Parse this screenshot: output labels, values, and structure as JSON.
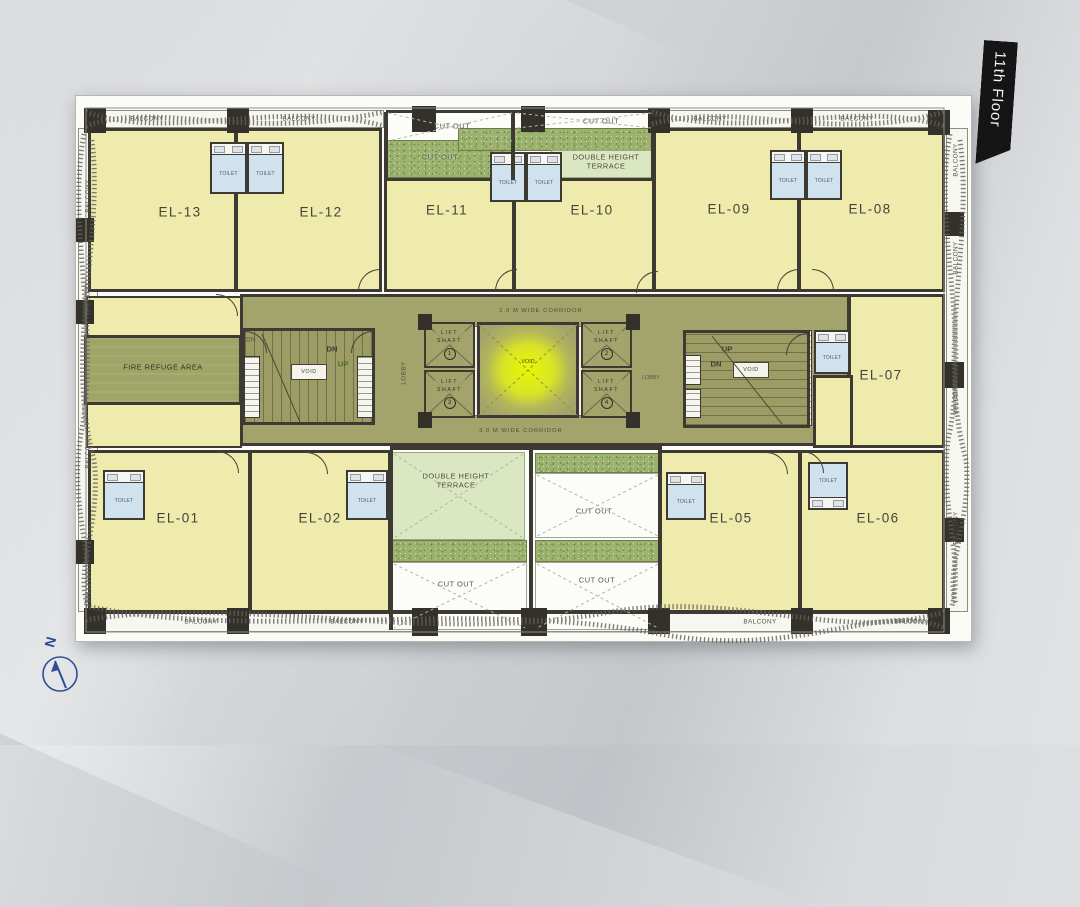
{
  "banner": {
    "text": "11th Floor"
  },
  "compass": {
    "north": "N"
  },
  "corridors": {
    "top": "2.0 M WIDE CORRIDOR",
    "bottom": "3.0 M WIDE CORRIDOR"
  },
  "areas": {
    "fire_refuge": "FIRE REFUGE AREA",
    "double_height_terrace": "DOUBLE HEIGHT TERRACE",
    "cut_out": "CUT OUT",
    "void": "VOID",
    "lobby": "LOBBY",
    "balcony": "BALCONY",
    "toilet": "TOILET",
    "up": "UP",
    "dn": "DN"
  },
  "lift_shafts": [
    {
      "label": "LIFT SHAFT",
      "number": "1"
    },
    {
      "label": "LIFT SHAFT",
      "number": "2"
    },
    {
      "label": "LIFT SHAFT",
      "number": "3"
    },
    {
      "label": "LIFT SHAFT",
      "number": "4"
    }
  ],
  "units": {
    "el01": "EL-01",
    "el02": "EL-02",
    "el05": "EL-05",
    "el06": "EL-06",
    "el07": "EL-07",
    "el08": "EL-08",
    "el09": "EL-09",
    "el10": "EL-10",
    "el11": "EL-11",
    "el12": "EL-12",
    "el13": "EL-13"
  },
  "colors": {
    "unit_fill": "#efebad",
    "corridor_fill": "#a3a46b",
    "terrace_fill": "#dbe7c3",
    "toilet_fill": "#cfe2ee",
    "wall": "#3c3a32",
    "void_glow": "#eaf600",
    "banner_bg": "#151515",
    "compass_blue": "#2f4e96",
    "paper": "#fbfbf7"
  }
}
